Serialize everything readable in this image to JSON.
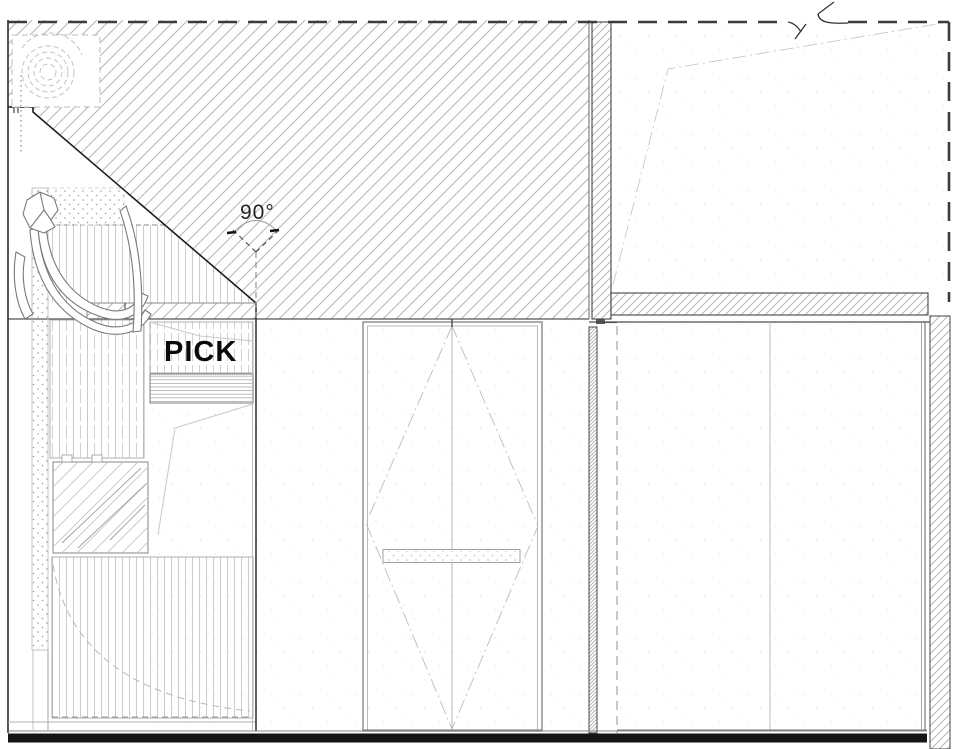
{
  "drawing": {
    "type": "architectural-detail-section",
    "labels": {
      "pick": "PICK",
      "angle": "90°"
    },
    "colors": {
      "paper": "#ffffff",
      "hatch_line": "#b5b5b5",
      "dark_line": "#2e2e2e",
      "dashed_edge": "#3c3c3c",
      "faint_line": "#c9c9c9",
      "black_band": "#151515",
      "pick_text": "#0a0a0a",
      "angle_text": "#222222"
    }
  }
}
